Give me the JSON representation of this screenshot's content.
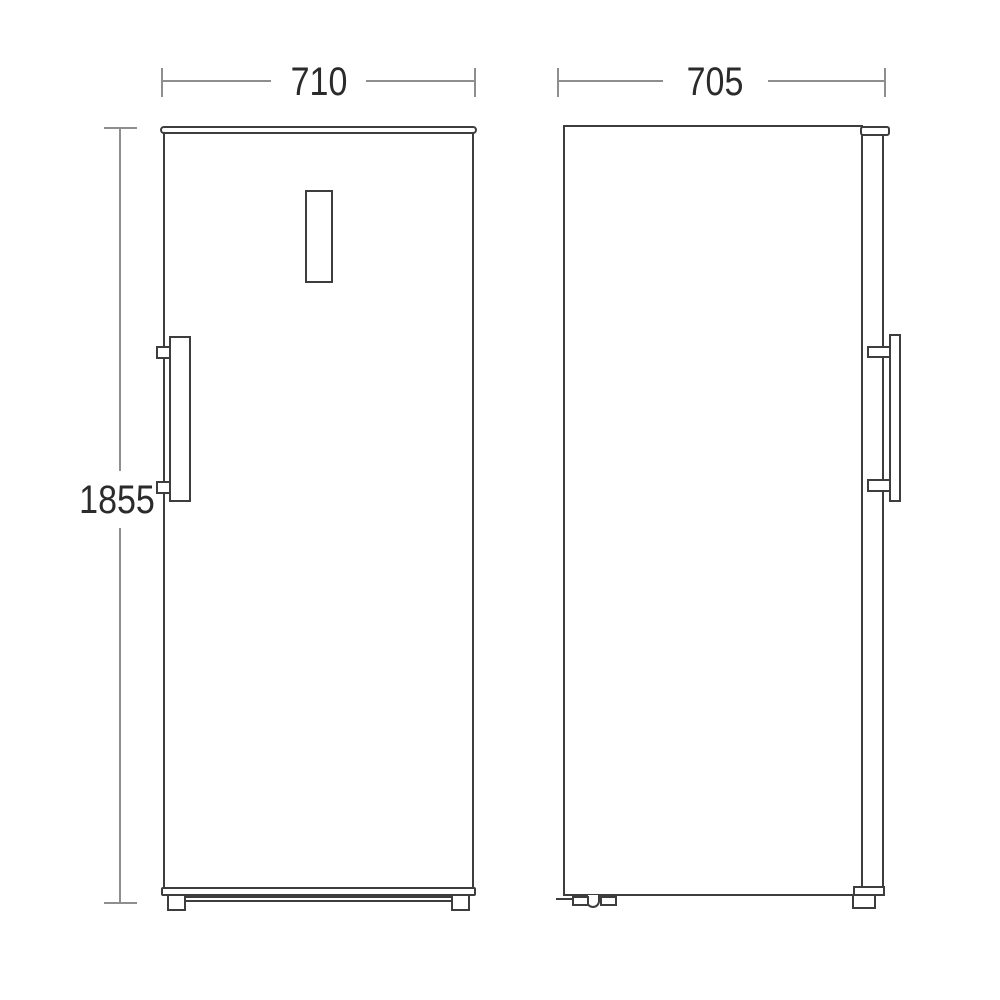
{
  "dimensions": {
    "width": {
      "label": "710"
    },
    "depth": {
      "label": "705"
    },
    "height": {
      "label": "1855"
    }
  },
  "colors": {
    "outline": "#3d3d3d",
    "dimension_line": "#8e8e8e",
    "label_text": "#2b2b2b",
    "background": "#ffffff"
  }
}
